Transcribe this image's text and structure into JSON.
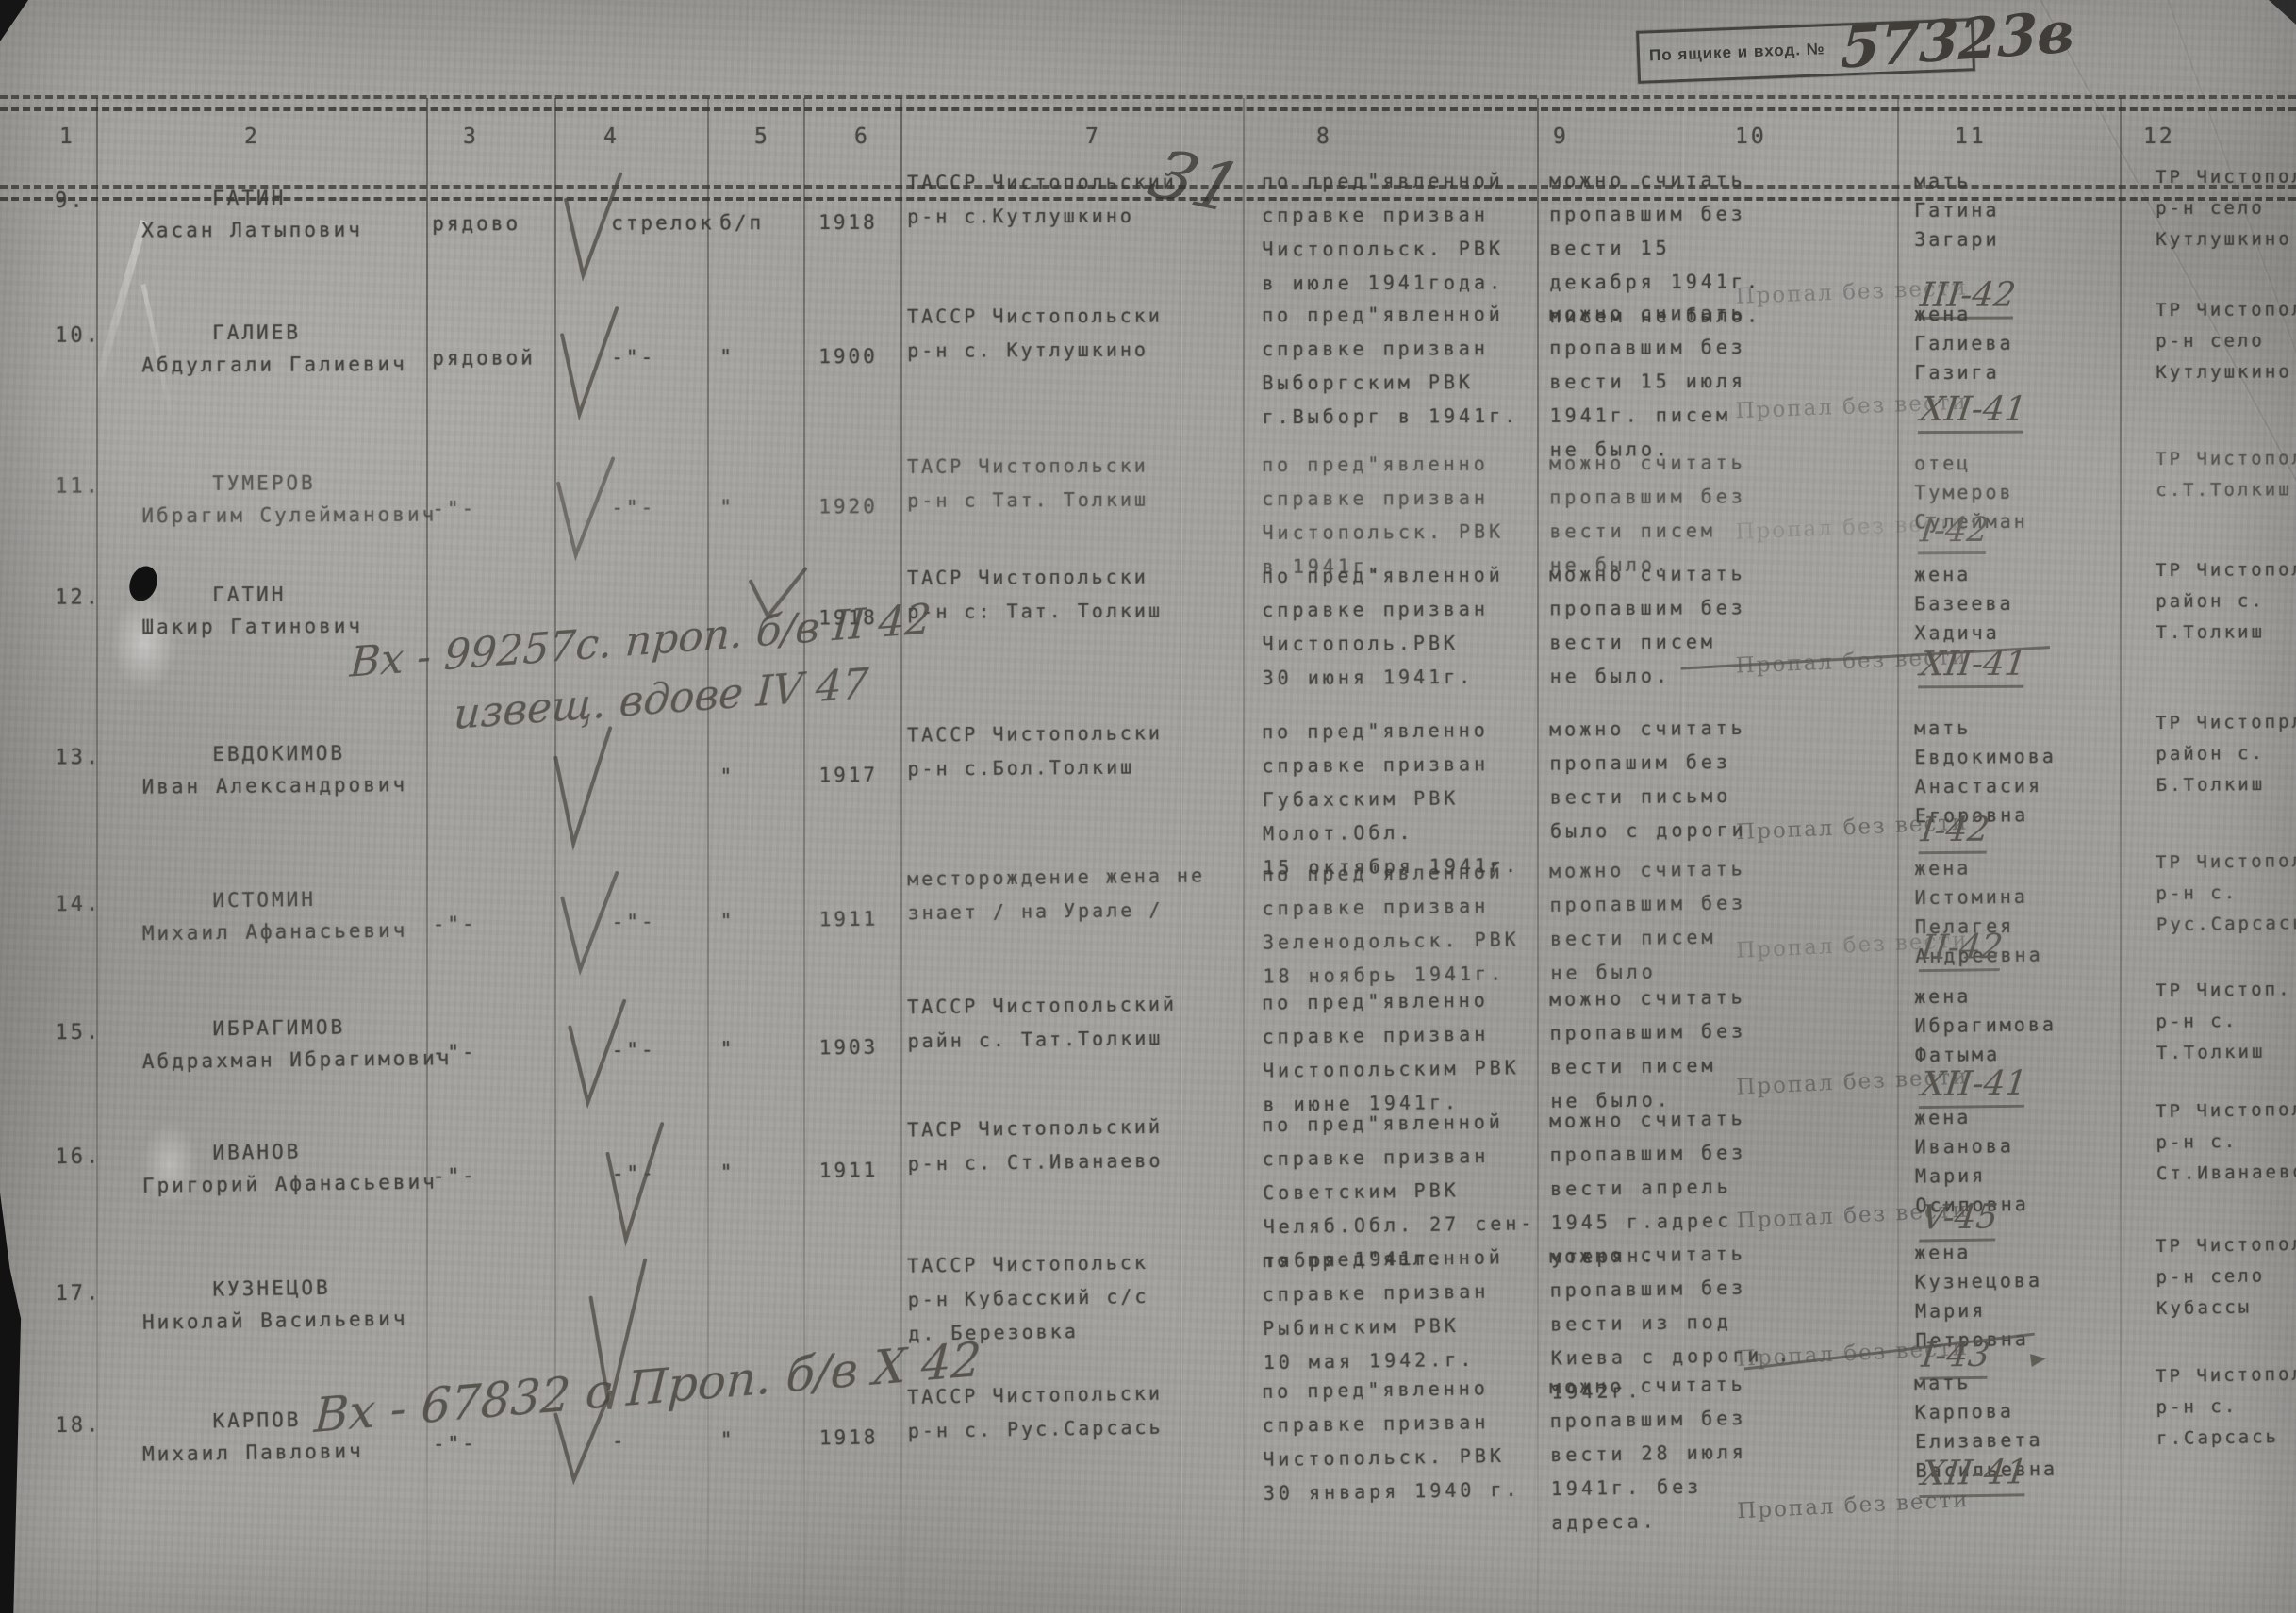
{
  "stamp_box": {
    "prefix": "По ящике и вход. №",
    "number": "57323в"
  },
  "header": {
    "columns": [
      "1",
      "2",
      "3",
      "4",
      "5",
      "6",
      "7",
      "8",
      "9",
      "10",
      "11",
      "12"
    ]
  },
  "annotations": {
    "mark_top": "31"
  },
  "stamp_text": "Пропал без вести",
  "rows": [
    {
      "num": "9.",
      "name": [
        "ГАТИН",
        "Хасан Латыпович"
      ],
      "rank": "рядово",
      "spec": "стрелок",
      "party": "б/п",
      "year": "1918",
      "place": [
        "ТАССР Чистопольский",
        "р-н с.Кутлушкино"
      ],
      "drafted": [
        "по пред\"явленной",
        "справке призван",
        "Чистопольск. РВК",
        "в июле 1941года."
      ],
      "missing": [
        "можно считать",
        "пропавшим без",
        "вести 15",
        "декабря 1941г.",
        "писем не было."
      ],
      "date": "III-42",
      "relative": [
        "мать",
        "Гатина",
        "Загари"
      ],
      "address": [
        "ТР Чистополь.",
        "р-н село",
        "Кутлушкино"
      ]
    },
    {
      "num": "10.",
      "name": [
        "ГАЛИЕВ",
        "Абдулгали Галиевич"
      ],
      "rank": "рядовой",
      "spec": "-\"-",
      "party": "\"",
      "year": "1900",
      "place": [
        "ТАССР Чистопольски",
        "р-н с. Кутлушкино"
      ],
      "drafted": [
        "по пред\"явленной",
        "справке призван",
        "Выборгским РВК",
        "г.Выборг в 1941г."
      ],
      "missing": [
        "можно считать",
        "пропавшим без",
        "вести 15 июля",
        "1941г. писем",
        "не было."
      ],
      "date": "XII-41",
      "relative": [
        "жена",
        "Галиева",
        "Газига"
      ],
      "address": [
        "ТР Чистополь.",
        "р-н село",
        "Кутлушкино"
      ]
    },
    {
      "num": "11.",
      "name": [
        "ТУМЕРОВ",
        "Ибрагим Сулейманович"
      ],
      "rank": "-\"-",
      "spec": "-\"-",
      "party": "\"",
      "year": "1920",
      "place": [
        "ТАСР Чистопольски",
        "р-н с Тат. Толкиш"
      ],
      "drafted": [
        "по пред\"явленно",
        "справке призван",
        "Чистопольск. РВК",
        "в 1941г."
      ],
      "missing": [
        "можно считать",
        "пропавшим без",
        "вести писем",
        "не было."
      ],
      "date": "I-42",
      "relative": [
        "отец",
        "Тумеров",
        "Сулейман"
      ],
      "address": [
        "ТР Чистопольс.",
        "с.Т.Толкиш"
      ]
    },
    {
      "num": "12.",
      "name": [
        "ГАТИН",
        "Шакир Гатинович"
      ],
      "rank": "",
      "spec": "",
      "party": "",
      "year": "1918",
      "place": [
        "ТАСР Чистопольски",
        "р-н с: Тат. Толкиш"
      ],
      "drafted": [
        "по пред\"явленной",
        "справке призван",
        "Чистополь.РВК",
        "30 июня 1941г."
      ],
      "missing": [
        "можно считать",
        "пропавшим без",
        "вести писем",
        "не было."
      ],
      "date": "XII-41",
      "relative": [
        "жена",
        "Базеева",
        "Хадича"
      ],
      "address": [
        "ТР Чистопольс",
        "район с.",
        "Т.Толкиш"
      ],
      "annotation": [
        "Вх - 99257с.  проп. б/в  II 42",
        "извещ. вдове  IV 47"
      ]
    },
    {
      "num": "13.",
      "name": [
        "ЕВДОКИМОВ",
        "Иван Александрович"
      ],
      "rank": "",
      "spec": "",
      "party": "\"",
      "year": "1917",
      "place": [
        "ТАССР Чистопольски",
        "р-н с.Бол.Толкиш"
      ],
      "drafted": [
        "по пред\"явленно",
        "справке призван",
        "Губахским РВК",
        "Молот.Обл.",
        "15 октября 1941г."
      ],
      "missing": [
        "можно считать",
        "пропашим без",
        "вести письмо",
        "было с дороги"
      ],
      "date": "I-42",
      "relative": [
        "мать",
        "Евдокимова",
        "Анастасия",
        "Егоровна"
      ],
      "address": [
        "ТР Чистопрл.",
        "район с.",
        "Б.Толкиш"
      ]
    },
    {
      "num": "14.",
      "name": [
        "ИСТОМИН",
        "Михаил Афанасьевич"
      ],
      "rank": "-\"-",
      "spec": "-\"-",
      "party": "\"",
      "year": "1911",
      "place": [
        "месторождение жена не",
        "знает / на Урале /"
      ],
      "drafted": [
        "по пред\"явленной",
        "справке призван",
        "Зеленодольск. РВК",
        "18 ноябрь 1941г."
      ],
      "missing": [
        "можно считать",
        "пропавшим без",
        "вести писем",
        "не было"
      ],
      "date": "II-42",
      "relative": [
        "жена",
        "Истомина",
        "Пелагея",
        "Андреевна"
      ],
      "address": [
        "ТР Чистопол.",
        "р-н с.",
        "Рус.Сарсась"
      ]
    },
    {
      "num": "15.",
      "name": [
        "ИБРАГИМОВ",
        "Абдрахман Ибрагимович"
      ],
      "rank": "-\"-",
      "spec": "-\"-",
      "party": "\"",
      "year": "1903",
      "place": [
        "ТАССР Чистопольский",
        "райн с. Тат.Толкиш"
      ],
      "drafted": [
        "по пред\"явленно",
        "справке призван",
        "Чистопольским РВК",
        "в июне 1941г."
      ],
      "missing": [
        "можно считать",
        "пропавшим без",
        "вести писем",
        "не было."
      ],
      "date": "XII-41",
      "relative": [
        "жена",
        "Ибрагимова",
        "Фатыма"
      ],
      "address": [
        "ТР Чистоп.",
        "р-н с.",
        "Т.Толкиш"
      ]
    },
    {
      "num": "16.",
      "name": [
        "ИВАНОВ",
        "Григорий Афанасьевич"
      ],
      "rank": "-\"-",
      "spec": "-\"-",
      "party": "\"",
      "year": "1911",
      "place": [
        "ТАСР Чистопольский",
        "р-н с. Ст.Иванаево"
      ],
      "drafted": [
        "по пред\"явленной",
        "справке призван",
        "Советским РВК",
        "Челяб.Обл. 27 сен-",
        "тября 1941г."
      ],
      "missing": [
        "можно считать",
        "пропавшим без",
        "вести апрель",
        "1945 г.адрес",
        "утерян."
      ],
      "date": "V-45",
      "relative": [
        "жена",
        "Иванова",
        "Мария",
        "Осиповна"
      ],
      "address": [
        "ТР Чистопол.",
        "р-н с.",
        "Ст.Иванаево"
      ]
    },
    {
      "num": "17.",
      "name": [
        "КУЗНЕЦОВ",
        "Николай Васильевич"
      ],
      "rank": "",
      "spec": "",
      "party": "",
      "year": "",
      "place": [
        "ТАССР Чистопольск",
        "р-н Кубасский с/с",
        "д. Березовка"
      ],
      "drafted": [
        "по пред\"явленной",
        "справке призван",
        "Рыбинским РВК",
        "10 мая 1942.г."
      ],
      "missing": [
        "можно считать",
        "пропавшим без",
        "вести из под",
        "Киева с дороги .",
        "1942г."
      ],
      "date": "I-43",
      "relative": [
        "жена",
        "Кузнецова",
        "Мария",
        "Петровна"
      ],
      "address": [
        "ТР Чистопол.",
        "р-н село",
        "Кубассы"
      ],
      "annotation": [
        "Вх - 67832 с  Проп. б/в  X 42"
      ]
    },
    {
      "num": "18.",
      "name": [
        "КАРПОВ",
        "Михаил Павлович"
      ],
      "rank": "-\"-",
      "spec": "-",
      "party": "\"",
      "year": "1918",
      "place": [
        "ТАССР Чистопольски",
        "р-н с. Рус.Сарсась"
      ],
      "drafted": [
        "по пред\"явленно",
        "справке призван",
        "Чистопольск. РВК",
        "30 января 1940 г."
      ],
      "missing": [
        "можно считать",
        "пропавшим без",
        "вести 28 июля",
        "1941г. без",
        "адреса."
      ],
      "date": "XII-41",
      "relative": [
        "мать",
        "Карпова",
        "Елизавета",
        "Васильевна"
      ],
      "address": [
        "ТР Чистопол.",
        "р-н с.",
        "г.Сарсась"
      ]
    }
  ]
}
